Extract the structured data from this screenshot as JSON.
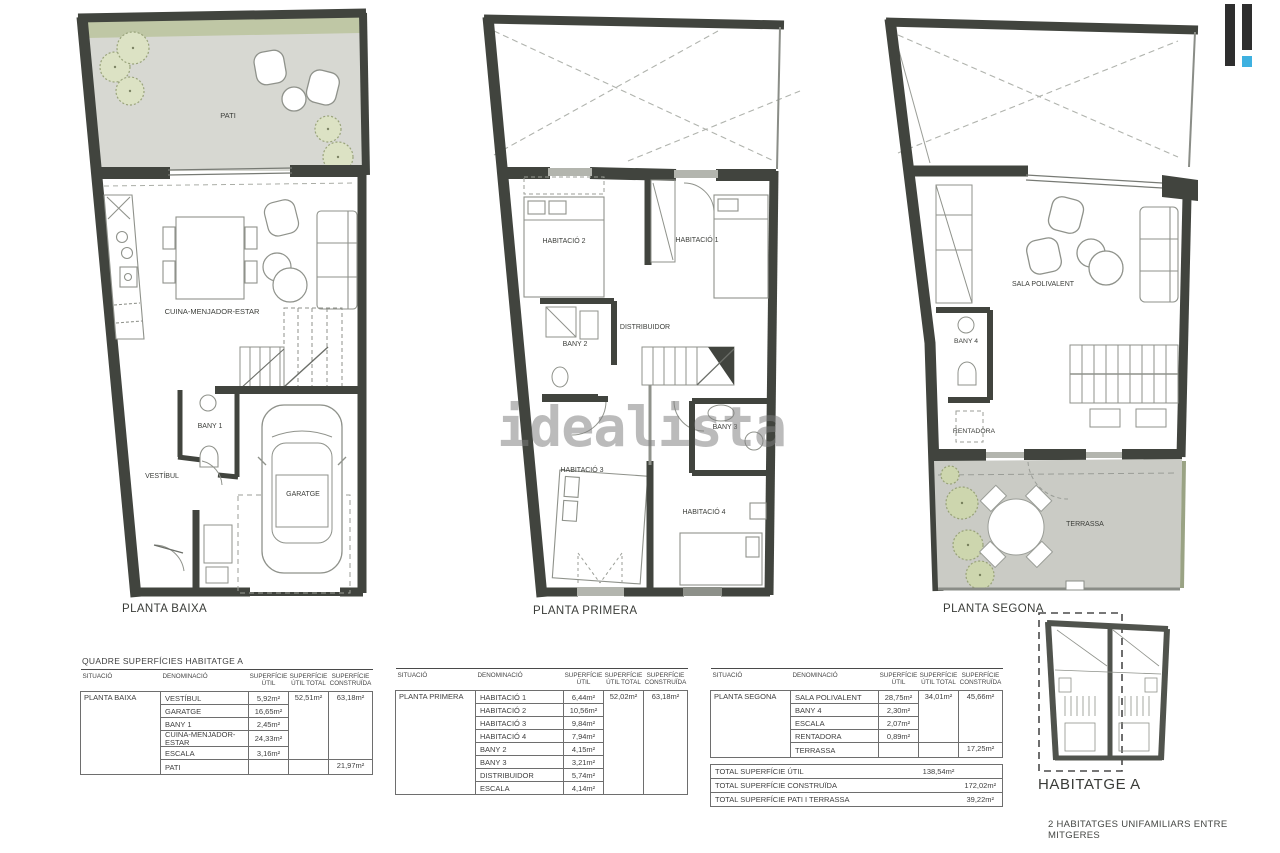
{
  "watermark": "idealista",
  "logo": {
    "name": "idealista-logo",
    "bar_color": "#2e2e2e",
    "accent_color": "#3eb1e0"
  },
  "colors": {
    "wall": "#41443e",
    "patio_floor": "#d7d8d2",
    "terrace_floor": "#cacbc5",
    "greenery": "#c3cca6",
    "tree_fill": "#d9e0bf",
    "furniture_stroke": "#8f928b",
    "window_light": "#b3b5ae"
  },
  "plan1": {
    "label": "PLANTA BAIXA",
    "pati": "PATI",
    "cuina": "CUINA-MENJADOR-ESTAR",
    "vestibul": "VESTÍBUL",
    "bany1": "BANY 1",
    "garatge": "GARATGE"
  },
  "plan2": {
    "label": "PLANTA PRIMERA",
    "hab1": "HABITACIÓ 1",
    "hab2": "HABITACIÓ 2",
    "hab3": "HABITACIÓ 3",
    "hab4": "HABITACIÓ 4",
    "bany2": "BANY 2",
    "bany3": "BANY 3",
    "distribuidor": "DISTRIBUIDOR"
  },
  "plan3": {
    "label": "PLANTA SEGONA",
    "sala": "SALA POLIVALENT",
    "bany4": "BANY 4",
    "rentadora": "RENTADORA",
    "terrassa": "TERRASSA"
  },
  "tables": {
    "title": "QUADRE SUPERFÍCIES HABITATGE A",
    "headers": {
      "situacio": "SITUACIÓ",
      "denominacio": "DENOMINACIÓ",
      "util": "SUPERFÍCIE ÚTIL",
      "utilTotal": "SUPERFÍCIE ÚTIL TOTAL",
      "construida": "SUPERFÍCIE CONSTRUÏDA"
    },
    "t1": {
      "situacio": "PLANTA BAIXA",
      "rows": [
        {
          "name": "VESTÍBUL",
          "util": "5,92m²",
          "utilTotal": "52,51m²",
          "utilTotalSpan": 5,
          "construida": "63,18m²",
          "construidaSpan": 5
        },
        {
          "name": "GARATGE",
          "util": "16,65m²"
        },
        {
          "name": "BANY 1",
          "util": "2,45m²"
        },
        {
          "name": "CUINA-MENJADOR-ESTAR",
          "util": "24,33m²"
        },
        {
          "name": "ESCALA",
          "util": "3,16m²"
        },
        {
          "name": "PATI",
          "util": "",
          "utilTotal": "",
          "utilTotalSpan": 1,
          "construida": "21,97m²",
          "construidaSpan": 1
        }
      ]
    },
    "t2": {
      "situacio": "PLANTA PRIMERA",
      "rows": [
        {
          "name": "HABITACIÓ 1",
          "util": "6,44m²",
          "utilTotal": "52,02m²",
          "utilTotalSpan": 8,
          "construida": "63,18m²",
          "construidaSpan": 8
        },
        {
          "name": "HABITACIÓ 2",
          "util": "10,56m²"
        },
        {
          "name": "HABITACIÓ 3",
          "util": "9,84m²"
        },
        {
          "name": "HABITACIÓ 4",
          "util": "7,94m²"
        },
        {
          "name": "BANY 2",
          "util": "4,15m²"
        },
        {
          "name": "BANY 3",
          "util": "3,21m²"
        },
        {
          "name": "DISTRIBUIDOR",
          "util": "5,74m²"
        },
        {
          "name": "ESCALA",
          "util": "4,14m²"
        }
      ]
    },
    "t3": {
      "situacio": "PLANTA SEGONA",
      "rows": [
        {
          "name": "SALA POLIVALENT",
          "util": "28,75m²",
          "utilTotal": "34,01m²",
          "utilTotalSpan": 4,
          "construida": "45,66m²",
          "construidaSpan": 4
        },
        {
          "name": "BANY 4",
          "util": "2,30m²"
        },
        {
          "name": "ESCALA",
          "util": "2,07m²"
        },
        {
          "name": "RENTADORA",
          "util": "0,89m²"
        },
        {
          "name": "TERRASSA",
          "util": "",
          "utilTotal": "",
          "utilTotalSpan": 1,
          "construida": "17,25m²",
          "construidaSpan": 1
        }
      ]
    },
    "totals": [
      {
        "label": "TOTAL SUPERFÍCIE ÚTIL",
        "utilTotal": "138,54m²",
        "construida": ""
      },
      {
        "label": "TOTAL SUPERFÍCIE CONSTRUÏDA",
        "utilTotal": "",
        "construida": "172,02m²"
      },
      {
        "label": "TOTAL SUPERFÍCIE PATI I TERRASSA",
        "utilTotal": "",
        "construida": "39,22m²"
      }
    ]
  },
  "keyplan": {
    "label": "HABITATGE A"
  },
  "footer": "2 HABITATGES UNIFAMILIARS ENTRE MITGERES"
}
